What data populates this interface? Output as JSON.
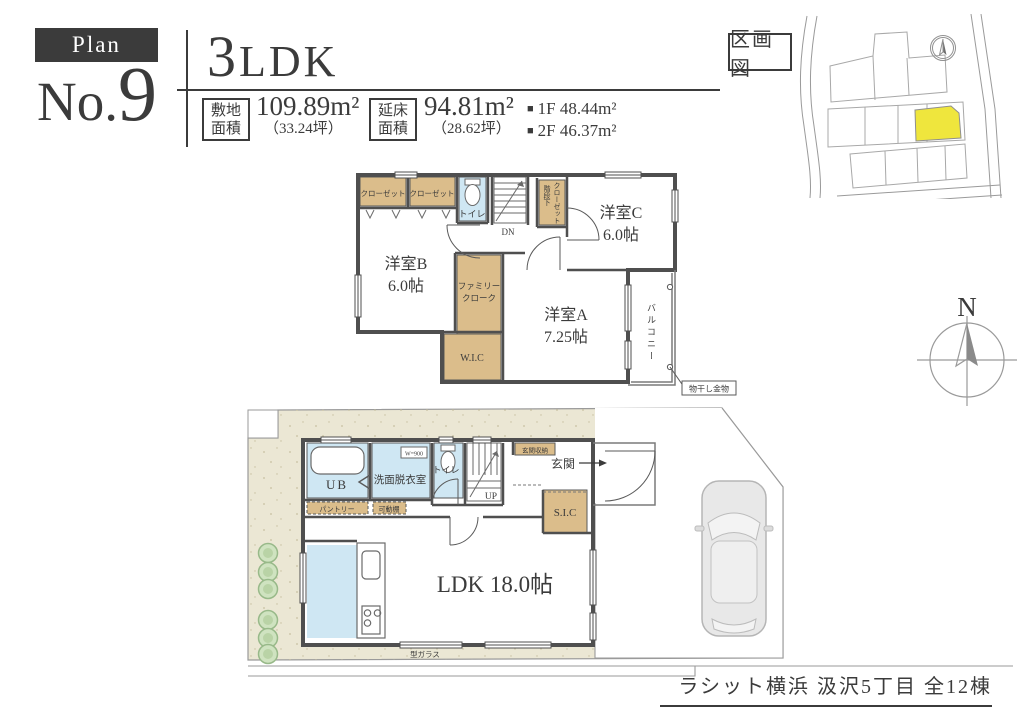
{
  "colors": {
    "ink": "#3b3b3b",
    "wall": "#4f4f4f",
    "closet_tan": "#dbbd8b",
    "water_blue": "#cfe7f3",
    "site_cream": "#ebe7d4",
    "lot_yellow": "#efe63d"
  },
  "header": {
    "plan_label": "Plan",
    "plan_no_prefix": "No.",
    "plan_no_digit": "9",
    "layout_digit": "3",
    "layout_suffix": "LDK",
    "bullet": "■",
    "site_area": {
      "label_line1": "敷地",
      "label_line2": "面積",
      "value": "109.89m²",
      "tsubo": "（33.24坪）"
    },
    "floor_area": {
      "label_line1": "延床",
      "label_line2": "面積",
      "value": "94.81m²",
      "tsubo": "（28.62坪）"
    },
    "floor_breakdown": [
      "1F 48.44m²",
      "2F 46.37m²"
    ]
  },
  "plot_map": {
    "title": "区画図"
  },
  "compass": {
    "north": "N"
  },
  "floor2": {
    "closets": [
      "クローゼット",
      "クローゼット"
    ],
    "toilet": "トイレ",
    "down_label": "DN",
    "stair_closet": [
      "階段下",
      "クローゼット"
    ],
    "rooms": {
      "b": {
        "name": "洋室B",
        "size": "6.0帖"
      },
      "c": {
        "name": "洋室C",
        "size": "6.0帖"
      },
      "a": {
        "name": "洋室A",
        "size": "7.25帖"
      }
    },
    "family_cloak": [
      "ファミリー",
      "クローク"
    ],
    "wic": "W.I.C",
    "balcony": "バルコニー",
    "hanger_note": "物干し金物"
  },
  "floor1": {
    "unit_bath": "UB",
    "washroom": "洗面脱衣室",
    "counter_width": "W=900",
    "toilet": "トイレ",
    "up_label": "UP",
    "entrance_storage": "玄関収納",
    "entrance": "玄関",
    "shoe_closet": "S.I.C",
    "pantry": "パントリー",
    "movable_shelf": "可動棚",
    "ldk": "LDK 18.0帖",
    "glass_note": "型ガラス"
  },
  "footer": {
    "project": "ラシット横浜 汲沢5丁目 全12棟"
  }
}
